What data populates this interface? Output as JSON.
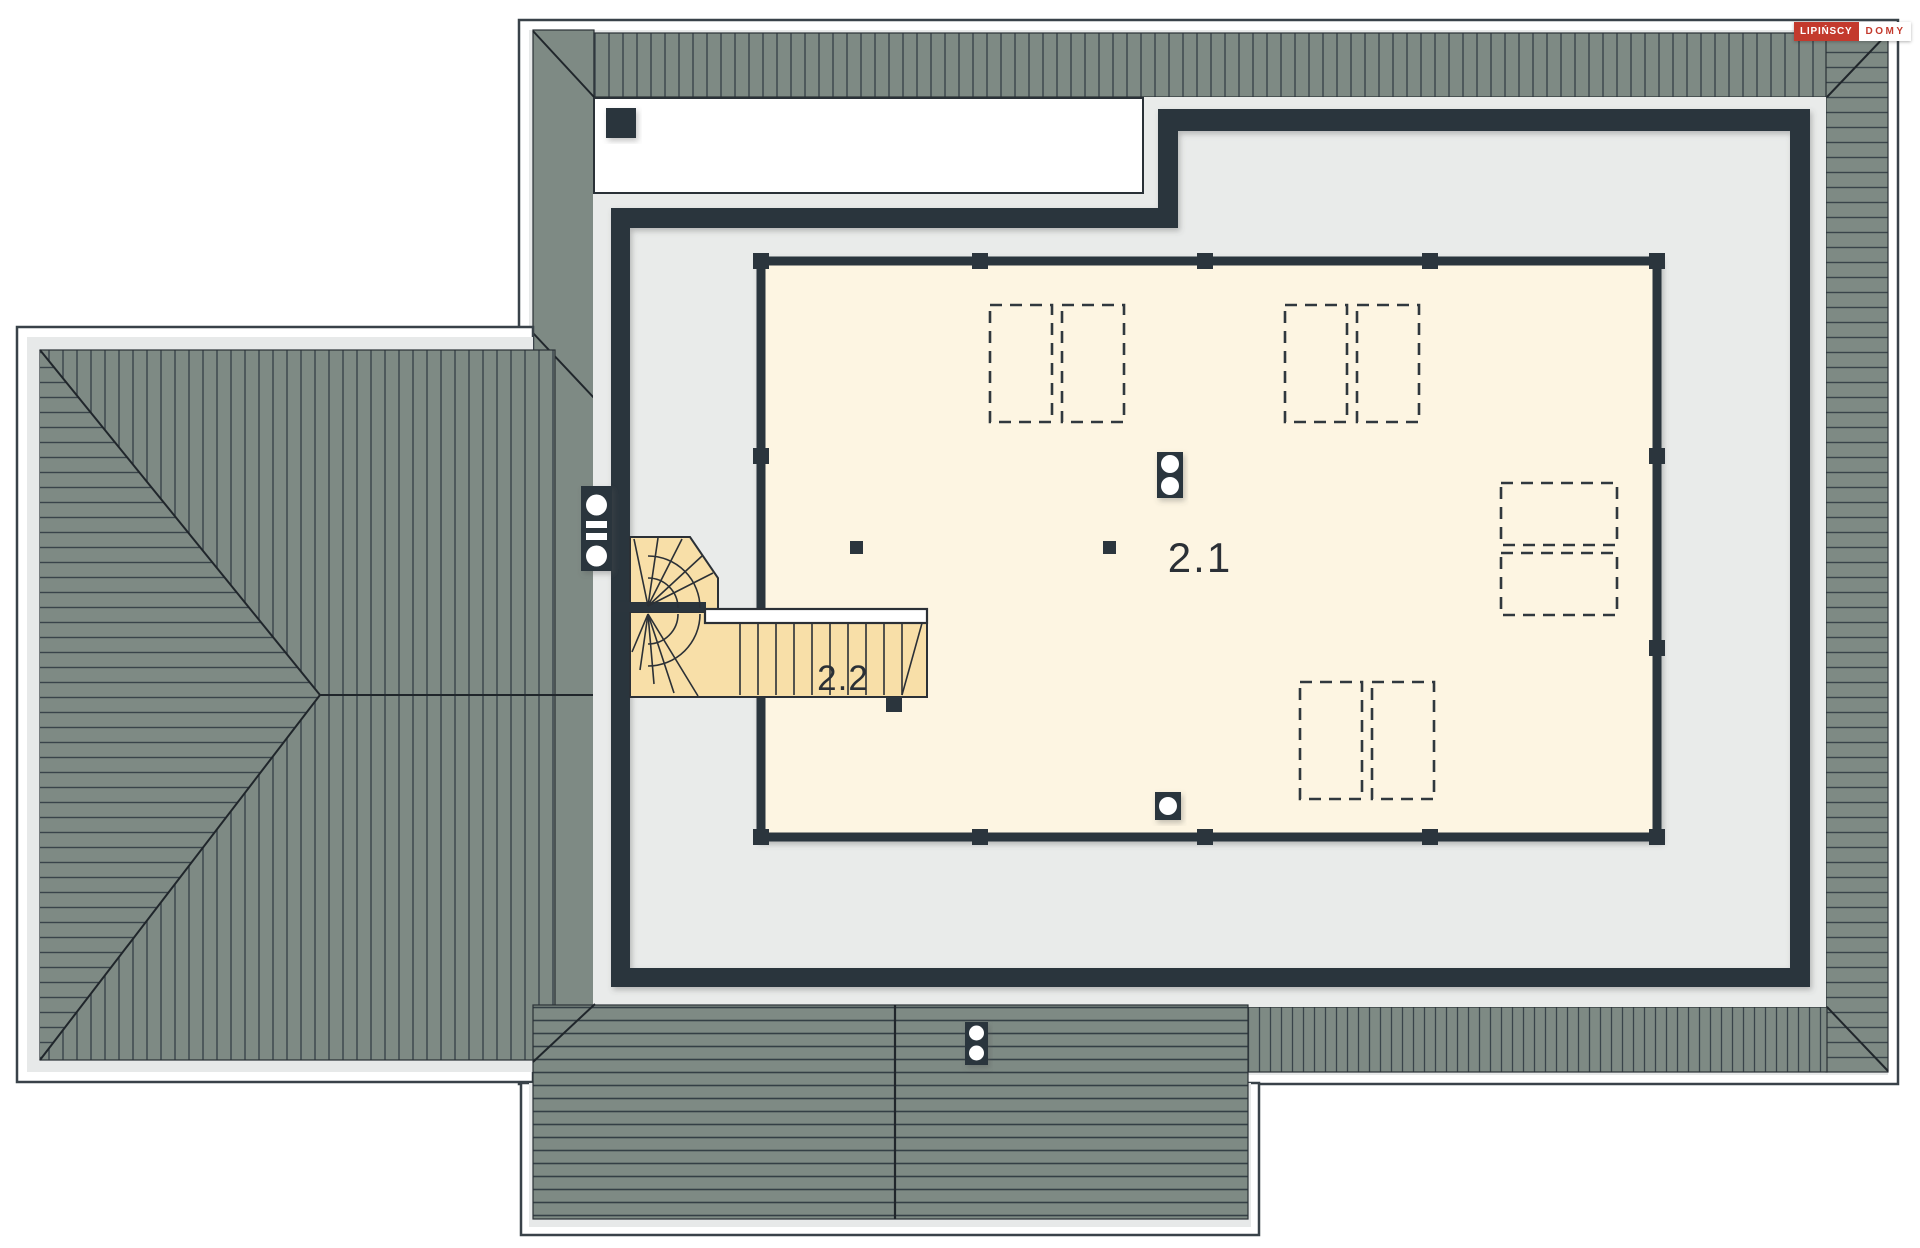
{
  "drawing": {
    "kind": "attic floor plan with roof view",
    "rooms": {
      "main": {
        "label": "2.1"
      },
      "stairs": {
        "label": "2.2"
      }
    }
  },
  "logo": {
    "brand": "LIPIŃSCY",
    "suffix": "DOMY"
  },
  "colors": {
    "roof": "#7e8a84",
    "roof_hatch_line": "#39444a",
    "wall_dark": "#2b353d",
    "floor_gray": "#e9ebea",
    "margin_gray": "#e7e9e9",
    "room_cream": "#fdf5e2",
    "stair_tan": "#f8dfa8",
    "dash_line": "#30383e",
    "brand_red": "#c33a2d",
    "page_white": "#ffffff"
  }
}
